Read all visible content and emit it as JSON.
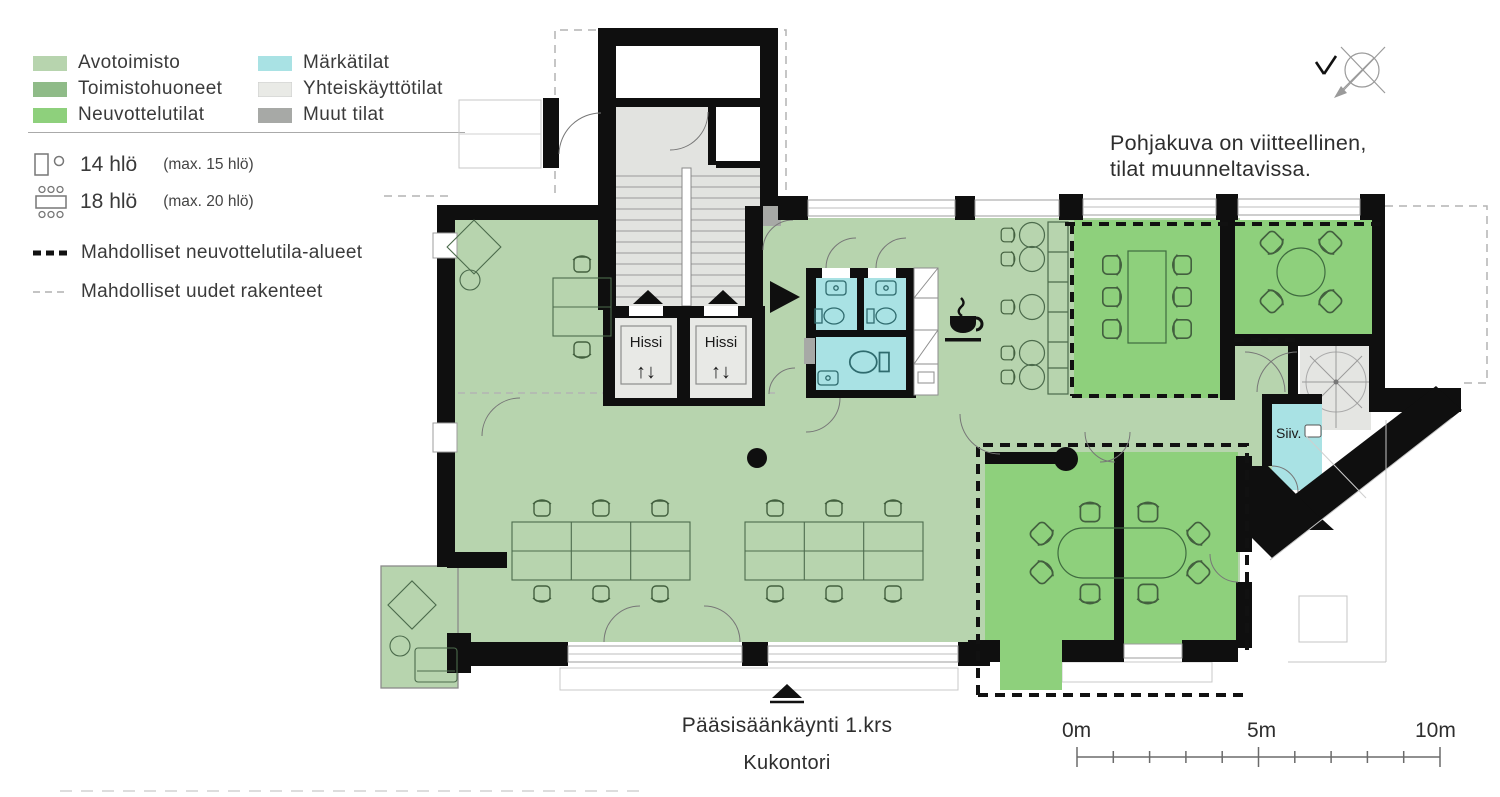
{
  "legend": {
    "items": [
      {
        "label": "Avotoimisto",
        "color": "#b7d4ae"
      },
      {
        "label": "Toimistohuoneet",
        "color": "#8fbb88"
      },
      {
        "label": "Neuvottelutilat",
        "color": "#8ed07c"
      },
      {
        "label": "Märkätilat",
        "color": "#a9e2e4"
      },
      {
        "label": "Yhteiskäyttötilat",
        "color": "#e9eae6"
      },
      {
        "label": "Muut tilat",
        "color": "#a7a9a6"
      }
    ],
    "capacity_rows": [
      {
        "icon": "single-workstation-icon",
        "count": "14 hlö",
        "max": "(max. 15 hlö)"
      },
      {
        "icon": "meeting-table-icon",
        "count": "18 hlö",
        "max": "(max. 20 hlö)"
      }
    ],
    "line_items": [
      {
        "icon": "bold-dashed-line-icon",
        "label": "Mahdolliset neuvottelutila-alueet",
        "color": "#111111"
      },
      {
        "icon": "thin-dashed-line-icon",
        "label": "Mahdolliset uudet rakenteet",
        "color": "#b0b0b0"
      }
    ]
  },
  "note": {
    "line1": "Pohjakuva on viitteellinen,",
    "line2": "tilat muunneltavissa."
  },
  "plan": {
    "elevator_label": "Hissi",
    "elevator_arrows": "↑↓",
    "cleaning_room_label": "Siiv.",
    "compass_icon": "north-arrow-icon",
    "entrance_icon": "entrance-arrow-icon",
    "coffee_icon": "coffee-cup-icon"
  },
  "entrance": {
    "label": "Pääsisäänkäynti 1.krs",
    "location": "Kukontori"
  },
  "scale_bar": {
    "labels": [
      "0m",
      "5m",
      "10m"
    ]
  }
}
